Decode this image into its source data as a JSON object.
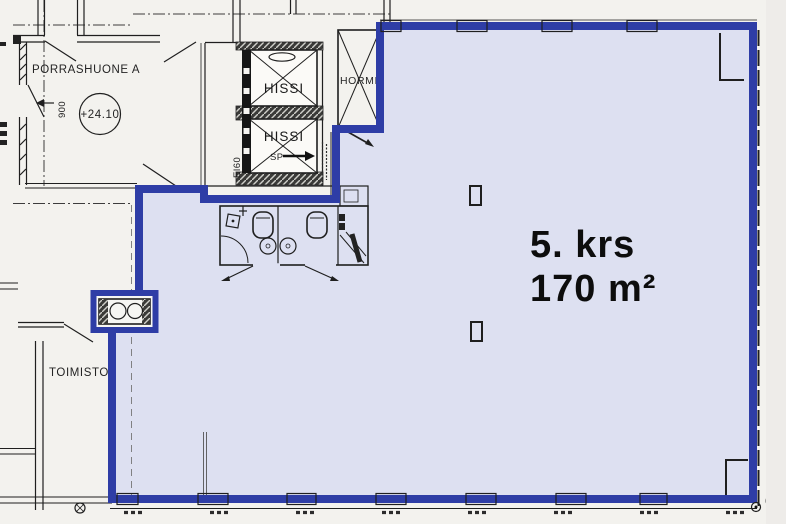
{
  "plan": {
    "unit_label": {
      "floor": "5. krs",
      "area": "170 m²"
    },
    "rooms": {
      "stairwell": "PORRASHUONE A",
      "offices": "TOIMISTOT",
      "elevator_upper": "HISSI",
      "elevator_lower": "HISSI",
      "duct_shaft": "HORMI"
    },
    "annotations": {
      "level_mark": "+24.10",
      "door_width": "900",
      "fire_rating": "EI60",
      "smoke_vent": "SP",
      "survey_point": "6"
    },
    "colors": {
      "highlight_fill": "#dde0f1",
      "boundary_blue": "#2e3da6",
      "linework": "#1f1f1f",
      "background": "#f3f2ee"
    }
  }
}
